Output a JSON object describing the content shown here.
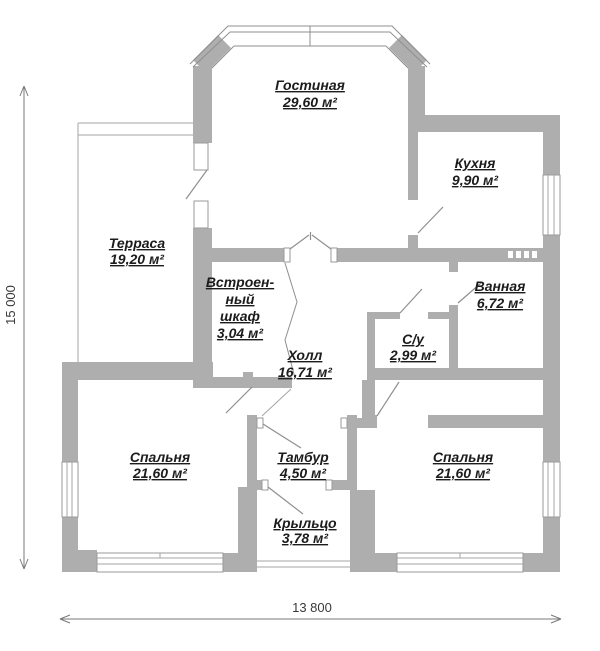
{
  "plan": {
    "type": "floor-plan",
    "rooms": {
      "living": {
        "name": "Гостиная",
        "area": "29,60 м²"
      },
      "kitchen": {
        "name": "Кухня",
        "area": "9,90 м²"
      },
      "terrace": {
        "name": "Терраса",
        "area": "19,20 м²"
      },
      "closet": {
        "name_line1": "Встроен-",
        "name_line2": "ный",
        "name_line3": "шкаф",
        "area": "3,04 м²"
      },
      "hall": {
        "name": "Холл",
        "area": "16,71 м²"
      },
      "bathroom": {
        "name": "Ванная",
        "area": "6,72 м²"
      },
      "wc": {
        "name": "С/у",
        "area": "2,99 м²"
      },
      "bedroom_left": {
        "name": "Спальня",
        "area": "21,60 м²"
      },
      "bedroom_right": {
        "name": "Спальня",
        "area": "21,60 м²"
      },
      "tambour": {
        "name": "Тамбур",
        "area": "4,50 м²"
      },
      "porch": {
        "name": "Крыльцо",
        "area": "3,78 м²"
      }
    },
    "dimensions": {
      "height_label": "15 000",
      "width_label": "13 800"
    },
    "colors": {
      "wall": "#aeaeae",
      "line": "#8f8f8f",
      "dimension_line": "#7a7a7a",
      "text": "#1c1c1c",
      "background": "#ffffff"
    }
  }
}
